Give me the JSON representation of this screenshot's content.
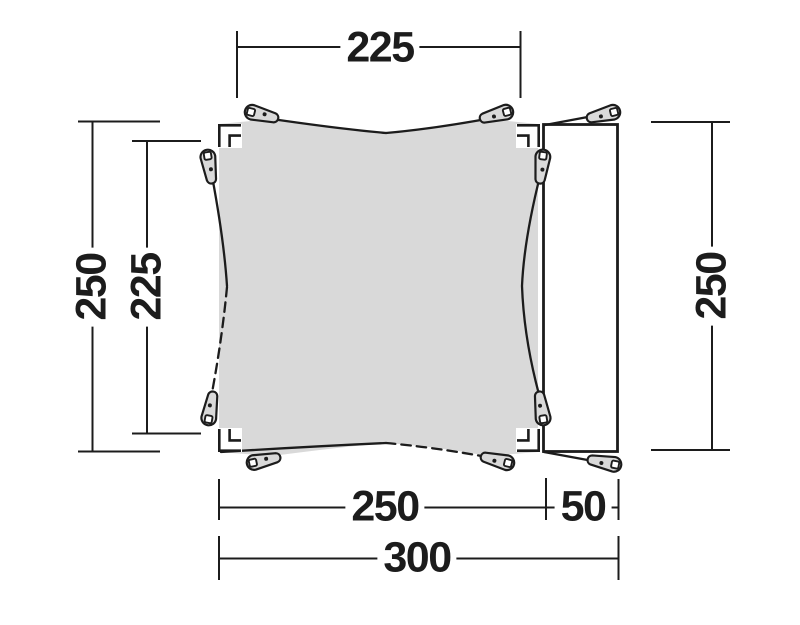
{
  "diagram": {
    "kind": "tent-footprint-dimension-diagram",
    "dimensions": {
      "top_width": "225",
      "left_height": "250",
      "left_inner_height": "225",
      "right_height": "250",
      "bottom_main_width": "250",
      "bottom_extension_width": "50",
      "bottom_total_width": "300"
    },
    "colors": {
      "line": "#1c1c1c",
      "canopy_fill": "#d9d9d9",
      "peg_fill": "#d9d9d9",
      "background": "#ffffff"
    },
    "icons": {
      "peg": "tent-peg-icon",
      "corner": "corner-bracket-icon"
    }
  }
}
